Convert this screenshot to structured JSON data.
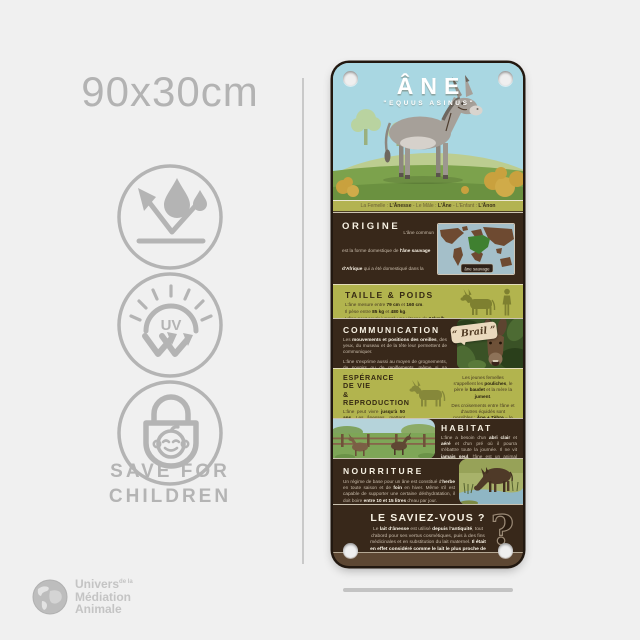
{
  "meta": {
    "size_label": "90x30cm",
    "colors": {
      "panel_dark": "#38281a",
      "panel_olive": "#b2b44e",
      "sky": "#a9d7e2",
      "page_bg": "#f0f0f0"
    }
  },
  "features": {
    "icons": [
      "water-resistant-icon",
      "uv-resistant-icon",
      "child-safe-lock-icon"
    ],
    "uv_label": "UV",
    "children_line1": "SAVE FOR",
    "children_line2": "CHILDREN"
  },
  "brand": {
    "word1": "Univers",
    "small": "de la",
    "word2": "Médiation",
    "word3": "Animale"
  },
  "panel": {
    "title": "ÂNE",
    "subtitle": "\"EQUUS ASINUS\"",
    "names": [
      {
        "t": "La Femelle : "
      },
      {
        "t": "L'Ânesse",
        "b": true
      },
      {
        "t": " - Le Mâle : "
      },
      {
        "t": "L'Âne",
        "b": true
      },
      {
        "t": " - L'Enfant : "
      },
      {
        "t": "L'Ânon",
        "b": true
      }
    ],
    "origine": {
      "heading": "ORIGINE",
      "body": [
        {
          "t": "L'âne commun est la forme domestique de "
        },
        {
          "t": "l'âne sauvage d'Afrique",
          "b": true
        },
        {
          "t": " qui a été domestiqué dans la vallée du Nil vers "
        },
        {
          "t": "5000 av. J.-C.",
          "b": true
        },
        {
          "t": " et utilisé très tôt dans l'histoire pour le transport des individus et des biens. Des siècles durant, l'âne est un animal de transport et un "
        },
        {
          "t": "outil agricole",
          "b": true
        },
        {
          "t": " au service des humains. Il permet l'essor du commerce et l'expansion de civilisations sur de grandes étendues, s'exportant du bassin méditerranéen vers l'Europe, puis vers les Amériques. Dans chaque pays, il remplit à moindre coût les mêmes fonctions que le cheval."
        }
      ],
      "map_label": "âne sauvage"
    },
    "taille": {
      "heading": "TAILLE & POIDS",
      "lines": [
        [
          {
            "t": "L'âne mesure entre "
          },
          {
            "t": "79 cm",
            "b": true
          },
          {
            "t": " et "
          },
          {
            "t": "160 cm",
            "b": true
          },
          {
            "t": "."
          }
        ],
        [
          {
            "t": "Il pèse entre "
          },
          {
            "t": "85 kg",
            "b": true
          },
          {
            "t": " et "
          },
          {
            "t": "480 kg",
            "b": true
          },
          {
            "t": "."
          }
        ],
        [
          {
            "t": "L'âne peut courir jusqu'à une vitesse de "
          },
          {
            "t": "24km/h",
            "b": true
          },
          {
            "t": "."
          }
        ]
      ]
    },
    "communication": {
      "heading": "COMMUNICATION",
      "p1": [
        {
          "t": "Les "
        },
        {
          "t": "mouvements et positions des oreilles",
          "b": true
        },
        {
          "t": ", des yeux, du museau et de la tête leur permettent de communiquer."
        }
      ],
      "p2": [
        {
          "t": "L'âne s'exprime aussi au moyen de grognements, de soupirs ou de reniflements, même si sa vocalise la plus populaire est "
        },
        {
          "t": "son braiment et son « hi-han »",
          "b": true
        },
        {
          "t": " si caractéristique."
        }
      ],
      "bubble": "“ Brail ”"
    },
    "esperance": {
      "heading_line1": "ESPÉRANCE DE VIE",
      "heading_line2": "& REPRODUCTION",
      "left": [
        {
          "t": "L'âne peut vivre "
        },
        {
          "t": "jusqu'à 50 ans",
          "b": true
        },
        {
          "t": ". Les ânesses, mettent bas après "
        },
        {
          "t": "1 an de gestation",
          "b": true
        },
        {
          "t": ". Le petit "
        },
        {
          "t": "ânon",
          "b": true
        },
        {
          "t": " peut se lever et courir peu de temps après sa naissance. L'âne est réputé pour avoir une sexualité ardente et agressive."
        }
      ],
      "right1": [
        {
          "t": "Les jeunes femelles s'appellent les "
        },
        {
          "t": "pouliches",
          "b": true
        },
        {
          "t": ", le père le "
        },
        {
          "t": "baudet",
          "b": true
        },
        {
          "t": " et la mère la "
        },
        {
          "t": "jument",
          "b": true
        },
        {
          "t": "."
        }
      ],
      "right2": [
        {
          "t": "Des croisements entre l'âne et d'autres équidés sont possibles : "
        },
        {
          "t": "Âne + Zèbre",
          "b": true
        },
        {
          "t": " = le "
        },
        {
          "t": "Zébrâne",
          "b": true
        },
        {
          "t": " / "
        },
        {
          "t": "Jument + Âne",
          "b": true
        },
        {
          "t": " = le "
        },
        {
          "t": "mulet",
          "b": true
        },
        {
          "t": " ou la "
        },
        {
          "t": "mule",
          "b": true
        },
        {
          "t": " / "
        },
        {
          "t": "Étalon + Ânesse",
          "b": true
        },
        {
          "t": " = le "
        },
        {
          "t": "Bardot",
          "b": true
        },
        {
          "t": " ou la "
        },
        {
          "t": "Bardotte",
          "b": true
        },
        {
          "t": "."
        }
      ]
    },
    "habitat": {
      "heading": "HABITAT",
      "body": [
        {
          "t": "L'âne a besoin d'un "
        },
        {
          "t": "abri clair",
          "b": true
        },
        {
          "t": " et "
        },
        {
          "t": "aéré",
          "b": true
        },
        {
          "t": " et d'un pré où il pourra s'ébattre toute la journée. Il ne vit "
        },
        {
          "t": "jamais seul",
          "b": true
        },
        {
          "t": ", l'âne est un animal grégaire qui n'aime pas la solitude. Il peut se lier "
        },
        {
          "t": "d'amitié avec d'autres animaux",
          "b": true
        },
        {
          "t": " comme le cheval, la chèvre ou le mouton. Par ailleurs, il déteste la pluie car son poil, contrairement à celui des chevaux, absorbe l'eau, ce qui rend sa vie difficile."
        }
      ]
    },
    "nourriture": {
      "heading": "NOURRITURE",
      "body": [
        {
          "t": "Un régime de base pour un âne est constitué d'"
        },
        {
          "t": "herbe",
          "b": true
        },
        {
          "t": " en toute saison et de "
        },
        {
          "t": "foin",
          "b": true
        },
        {
          "t": " en hiver. Même s'il est capable de supporter une certaine déshydratation, il doit boire "
        },
        {
          "t": "entre 10 et 15 litres",
          "b": true
        },
        {
          "t": " d'eau par jour."
        }
      ]
    },
    "saviez": {
      "heading": "LE SAVIEZ-VOUS ?",
      "body": [
        {
          "t": "Le "
        },
        {
          "t": "lait d'ânesse",
          "b": true
        },
        {
          "t": " est utilisé "
        },
        {
          "t": "depuis l'antiquité",
          "b": true
        },
        {
          "t": ", tout d'abord pour ses vertus cosmétiques, puis à des fins médicinales et en substitution du lait maternel. "
        },
        {
          "t": "Il était en effet considéré comme le lait le plus proche de celui de la femme.",
          "b": true
        }
      ],
      "question_mark": "?"
    }
  }
}
